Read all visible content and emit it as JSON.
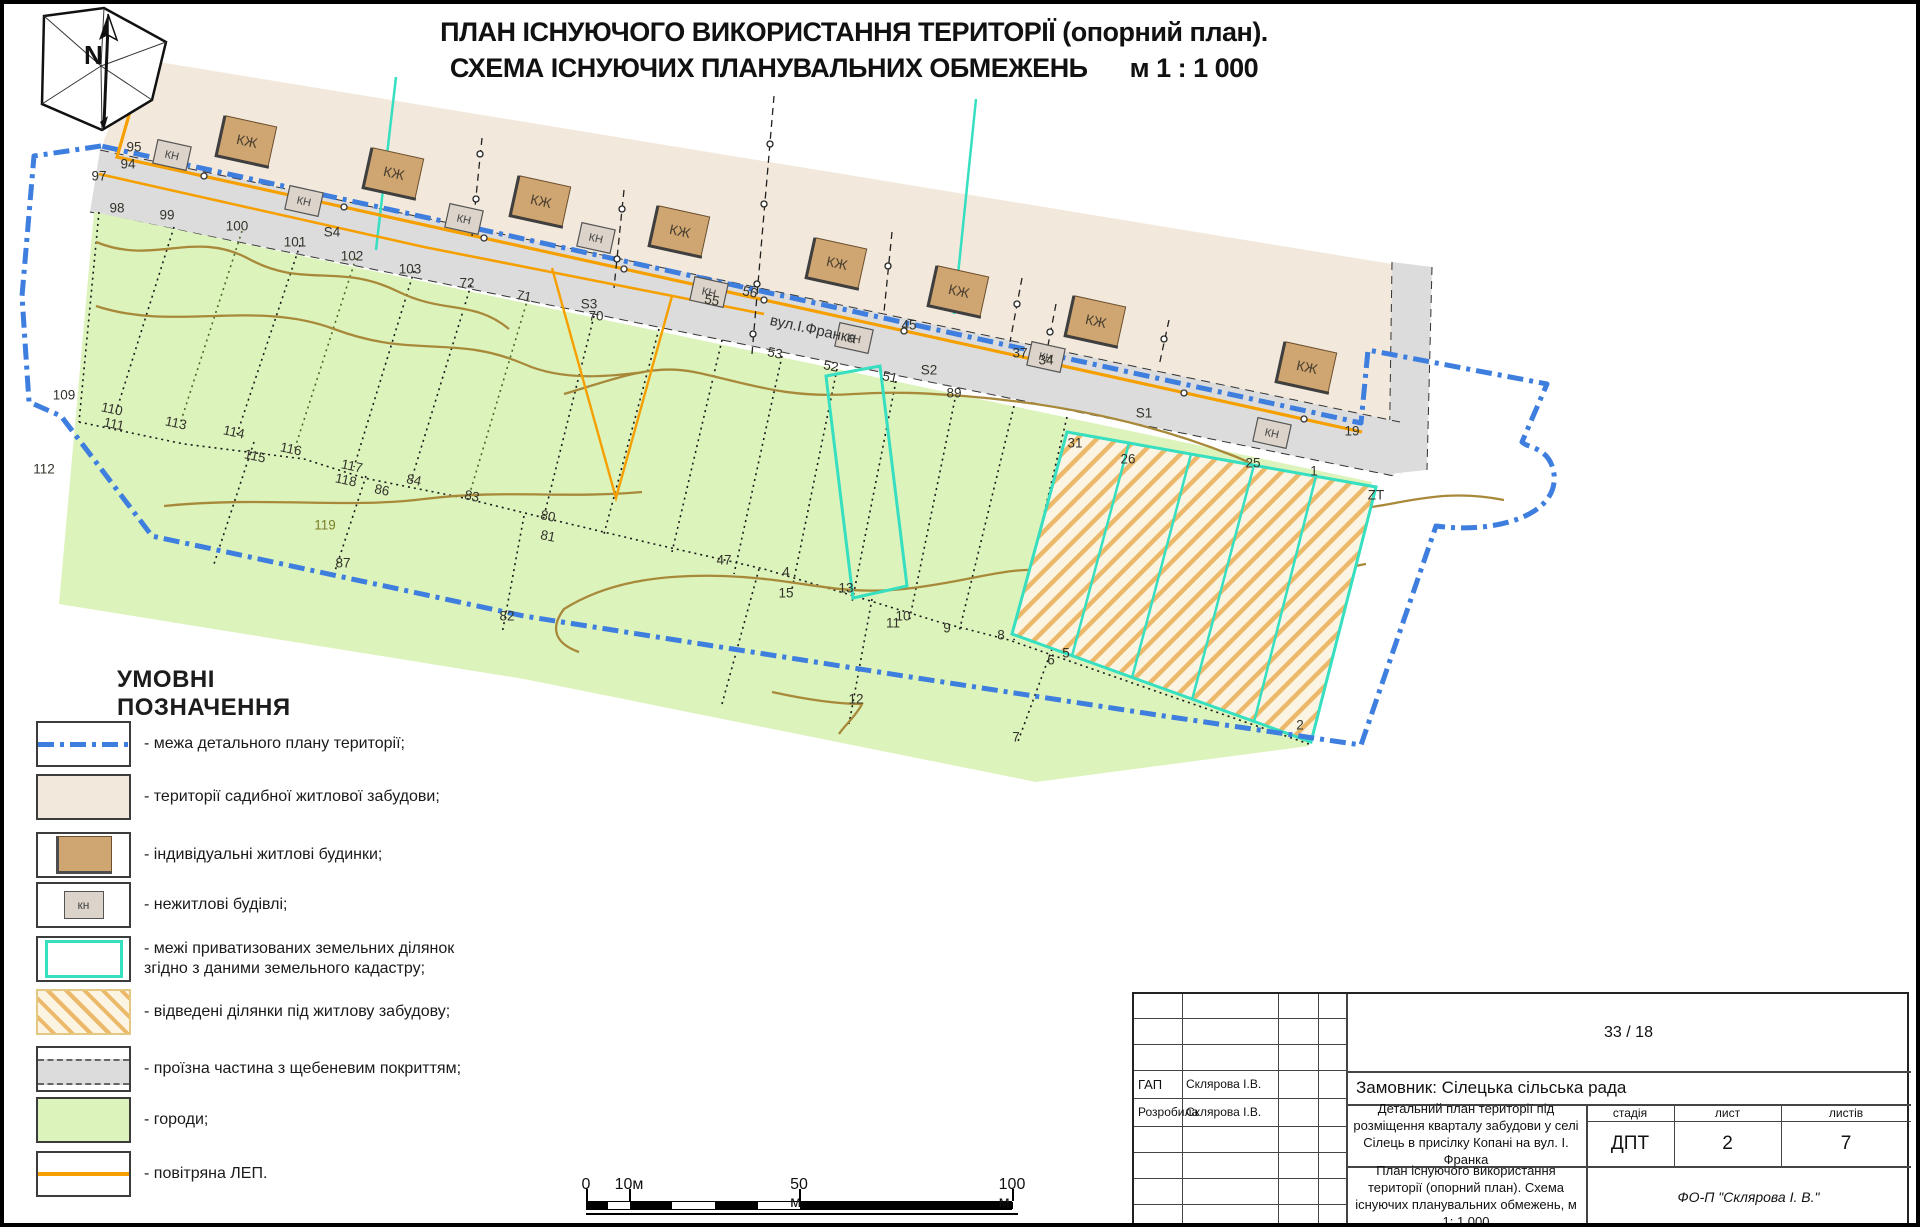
{
  "page_title": {
    "line1": "ПЛАН ІСНУЮЧОГО ВИКОРИСТАННЯ ТЕРИТОРІЇ (опорний план).",
    "line2": "СХЕМА ІСНУЮЧИХ ПЛАНУВАЛЬНИХ ОБМЕЖЕНЬ",
    "scale_note": "м 1 : 1 000"
  },
  "legend": {
    "heading": "УМОВНІ ПОЗНАЧЕННЯ",
    "kn_swatch_label": "кн",
    "items": [
      {
        "label": "- межа детального плану території;"
      },
      {
        "label": "- території садибної житлової забудови;"
      },
      {
        "label": "- індивідуальні житлові будинки;"
      },
      {
        "label": "- нежитлові будівлі;"
      },
      {
        "label": "- межі приватизованих земельних ділянок\nзгідно з даними земельного кадастру;"
      },
      {
        "label": "- відведені ділянки під житлову забудову;"
      },
      {
        "label": "- проїзна частина з щебеневим покриттям;"
      },
      {
        "label": "- городи;"
      },
      {
        "label": "- повітряна ЛЕП."
      }
    ]
  },
  "map": {
    "street_label": "вул.І.Франка",
    "house_label": "КЖ",
    "kn_label": "КН",
    "zt_label": "ZT",
    "houses": [
      {
        "x": 243,
        "y": 137
      },
      {
        "x": 390,
        "y": 169
      },
      {
        "x": 537,
        "y": 197
      },
      {
        "x": 676,
        "y": 227
      },
      {
        "x": 833,
        "y": 259
      },
      {
        "x": 955,
        "y": 287
      },
      {
        "x": 1092,
        "y": 317
      },
      {
        "x": 1303,
        "y": 363
      }
    ],
    "kn_boxes": [
      {
        "x": 168,
        "y": 151
      },
      {
        "x": 300,
        "y": 197
      },
      {
        "x": 460,
        "y": 215
      },
      {
        "x": 592,
        "y": 234
      },
      {
        "x": 705,
        "y": 288
      },
      {
        "x": 850,
        "y": 334
      },
      {
        "x": 1042,
        "y": 353
      },
      {
        "x": 1268,
        "y": 429
      }
    ],
    "point_labels": [
      {
        "t": "95",
        "x": 130,
        "y": 143
      },
      {
        "t": "94",
        "x": 124,
        "y": 160
      },
      {
        "t": "97",
        "x": 95,
        "y": 172
      },
      {
        "t": "98",
        "x": 113,
        "y": 204
      },
      {
        "t": "99",
        "x": 163,
        "y": 211
      },
      {
        "t": "100",
        "x": 233,
        "y": 222
      },
      {
        "t": "101",
        "x": 291,
        "y": 238
      },
      {
        "t": "102",
        "x": 348,
        "y": 252
      },
      {
        "t": "103",
        "x": 406,
        "y": 265
      },
      {
        "t": "72",
        "x": 463,
        "y": 279
      },
      {
        "t": "S4",
        "x": 328,
        "y": 228
      },
      {
        "t": "71",
        "x": 520,
        "y": 292,
        "r": 12
      },
      {
        "t": "S3",
        "x": 585,
        "y": 300
      },
      {
        "t": "70",
        "x": 592,
        "y": 312
      },
      {
        "t": "55",
        "x": 708,
        "y": 296,
        "r": 12
      },
      {
        "t": "56",
        "x": 746,
        "y": 288,
        "r": 12
      },
      {
        "t": "53",
        "x": 771,
        "y": 349,
        "r": 12
      },
      {
        "t": "52",
        "x": 827,
        "y": 362,
        "r": 12
      },
      {
        "t": "51",
        "x": 886,
        "y": 373,
        "r": 12
      },
      {
        "t": "S2",
        "x": 925,
        "y": 366
      },
      {
        "t": "89",
        "x": 950,
        "y": 389
      },
      {
        "t": "45",
        "x": 905,
        "y": 321
      },
      {
        "t": "37",
        "x": 1016,
        "y": 349
      },
      {
        "t": "34",
        "x": 1042,
        "y": 356
      },
      {
        "t": "S1",
        "x": 1140,
        "y": 409
      },
      {
        "t": "31",
        "x": 1071,
        "y": 439
      },
      {
        "t": "26",
        "x": 1124,
        "y": 455
      },
      {
        "t": "25",
        "x": 1249,
        "y": 459
      },
      {
        "t": "1",
        "x": 1310,
        "y": 467
      },
      {
        "t": "19",
        "x": 1348,
        "y": 427
      },
      {
        "t": "ZT",
        "x": 1372,
        "y": 491
      },
      {
        "t": "109",
        "x": 60,
        "y": 391
      },
      {
        "t": "110",
        "x": 108,
        "y": 405,
        "r": 12
      },
      {
        "t": "111",
        "x": 110,
        "y": 420,
        "r": 12
      },
      {
        "t": "112",
        "x": 40,
        "y": 465
      },
      {
        "t": "113",
        "x": 172,
        "y": 419,
        "r": 12
      },
      {
        "t": "114",
        "x": 230,
        "y": 428,
        "r": 12
      },
      {
        "t": "115",
        "x": 251,
        "y": 452,
        "r": 12
      },
      {
        "t": "116",
        "x": 287,
        "y": 445,
        "r": 12
      },
      {
        "t": "117",
        "x": 348,
        "y": 462,
        "r": 12
      },
      {
        "t": "118",
        "x": 342,
        "y": 476,
        "r": 12
      },
      {
        "t": "86",
        "x": 378,
        "y": 486,
        "r": 12
      },
      {
        "t": "84",
        "x": 410,
        "y": 476,
        "r": 12
      },
      {
        "t": "83",
        "x": 468,
        "y": 492,
        "r": 12
      },
      {
        "t": "80",
        "x": 544,
        "y": 512,
        "r": 12
      },
      {
        "t": "81",
        "x": 544,
        "y": 532,
        "r": 12
      },
      {
        "t": "119",
        "x": 321,
        "y": 521,
        "c": "#7a7f2a"
      },
      {
        "t": "87",
        "x": 339,
        "y": 559
      },
      {
        "t": "82",
        "x": 503,
        "y": 612
      },
      {
        "t": "47",
        "x": 720,
        "y": 556
      },
      {
        "t": "4",
        "x": 782,
        "y": 568
      },
      {
        "t": "15",
        "x": 782,
        "y": 589
      },
      {
        "t": "13",
        "x": 842,
        "y": 584
      },
      {
        "t": "10",
        "x": 899,
        "y": 612
      },
      {
        "t": "11",
        "x": 889,
        "y": 619
      },
      {
        "t": "9",
        "x": 943,
        "y": 624
      },
      {
        "t": "8",
        "x": 997,
        "y": 631
      },
      {
        "t": "5",
        "x": 1062,
        "y": 649
      },
      {
        "t": "6",
        "x": 1047,
        "y": 656
      },
      {
        "t": "12",
        "x": 852,
        "y": 695
      },
      {
        "t": "7",
        "x": 1012,
        "y": 733
      },
      {
        "t": "2",
        "x": 1296,
        "y": 721
      }
    ]
  },
  "scale_bar": {
    "labels": [
      {
        "t": "0",
        "x": 582
      },
      {
        "t": "10м",
        "x": 625
      },
      {
        "t": "50 м",
        "x": 795
      },
      {
        "t": "100 м",
        "x": 1008
      }
    ],
    "segments": [
      {
        "x1": 0,
        "x2": 21,
        "f": "#000"
      },
      {
        "x1": 21,
        "x2": 43,
        "f": "#fff"
      },
      {
        "x1": 43,
        "x2": 85,
        "f": "#000"
      },
      {
        "x1": 85,
        "x2": 128,
        "f": "#fff"
      },
      {
        "x1": 128,
        "x2": 171,
        "f": "#000"
      },
      {
        "x1": 171,
        "x2": 213,
        "f": "#fff"
      },
      {
        "x1": 213,
        "x2": 426,
        "f": "#000"
      }
    ]
  },
  "stamp": {
    "project_no": "33 / 18",
    "customer": "Замовник: Сілецька сільська рада",
    "roles": [
      {
        "role": "ГАП",
        "name": "Склярова І.В."
      },
      {
        "role": "Розробила",
        "name": "Склярова І.В."
      }
    ],
    "project_title": "Детальний план території під розміщення кварталу забудови у селі Сілець в присілку Копані на вул. І. Франка",
    "sheet_title": "План існуючого використання території (опорний план). Схема існуючих планувальних обмежень, м 1: 1 000",
    "stage_header": "стадія",
    "sheet_header": "лист",
    "sheets_header": "листів",
    "stage": "ДПТ",
    "sheet": "2",
    "sheets": "7",
    "company": "ФО-П \"Склярова І. В.\""
  },
  "colors": {
    "boundary_blue": "#3E7EDE",
    "residential_beige": "#F2E9DC",
    "house_brown": "#CFA571",
    "garden_green": "#DDF3BC",
    "road_gray": "#DCDCDC",
    "cadastre_cyan": "#35DFC0",
    "power_orange": "#F5A000",
    "hatch_line": "#ECB96B",
    "contour_olive": "#A8893A"
  }
}
